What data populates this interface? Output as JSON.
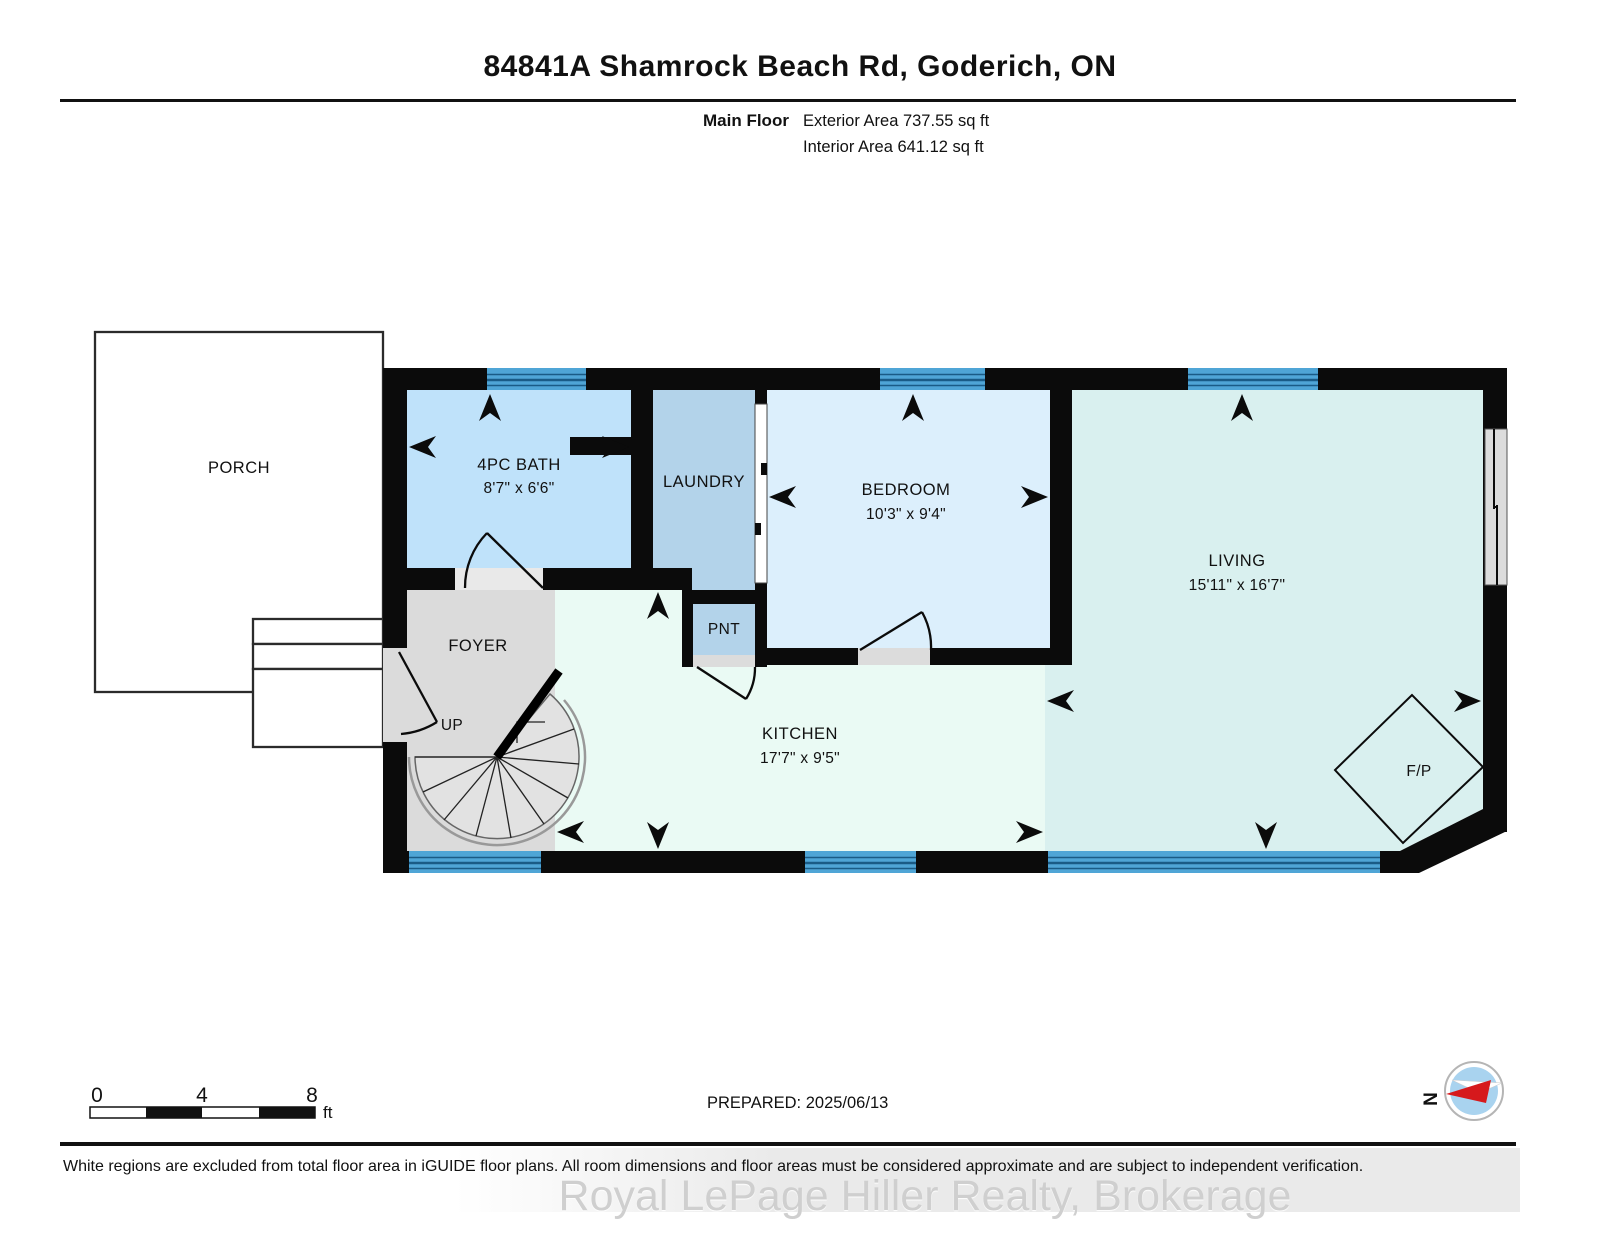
{
  "header": {
    "title": "84841A Shamrock Beach Rd, Goderich, ON",
    "floor_label": "Main Floor",
    "exterior_area": "Exterior Area 737.55 sq ft",
    "interior_area": "Interior Area 641.12 sq ft"
  },
  "rooms": {
    "porch": {
      "name": "PORCH"
    },
    "bath": {
      "name": "4PC BATH",
      "dims": "8'7\" x 6'6\""
    },
    "laundry": {
      "name": "LAUNDRY"
    },
    "bedroom": {
      "name": "BEDROOM",
      "dims": "10'3\" x 9'4\""
    },
    "living": {
      "name": "LIVING",
      "dims": "15'11\" x 16'7\""
    },
    "foyer": {
      "name": "FOYER"
    },
    "stairs": {
      "label": "UP"
    },
    "pantry": {
      "name": "PNT"
    },
    "kitchen": {
      "name": "KITCHEN",
      "dims": "17'7\" x 9'5\""
    },
    "fireplace": {
      "name": "F/P"
    }
  },
  "scale_bar": {
    "tick0": "0",
    "tick4": "4",
    "tick8": "8",
    "unit": "ft"
  },
  "footer": {
    "prepared": "PREPARED: 2025/06/13",
    "disclaimer": "White regions are excluded from total floor area in iGUIDE floor plans. All room dimensions and floor areas must be considered approximate and are subject to independent verification.",
    "watermark": "Royal LePage Hiller Realty, Brokerage",
    "compass_north": "N"
  },
  "colors": {
    "wall": "#0b0b0b",
    "bath": "#BFE2FA",
    "laundry": "#B3D3EA",
    "pantry": "#B3D3EA",
    "bedroom": "#DCEFFC",
    "living": "#D9F0EF",
    "kitchen": "#EAFAF4",
    "foyer": "#DBDBDB",
    "window_blue": "#4FA5D6",
    "compass_red": "#D6191C",
    "compass_disc": "#A9D3EF"
  }
}
